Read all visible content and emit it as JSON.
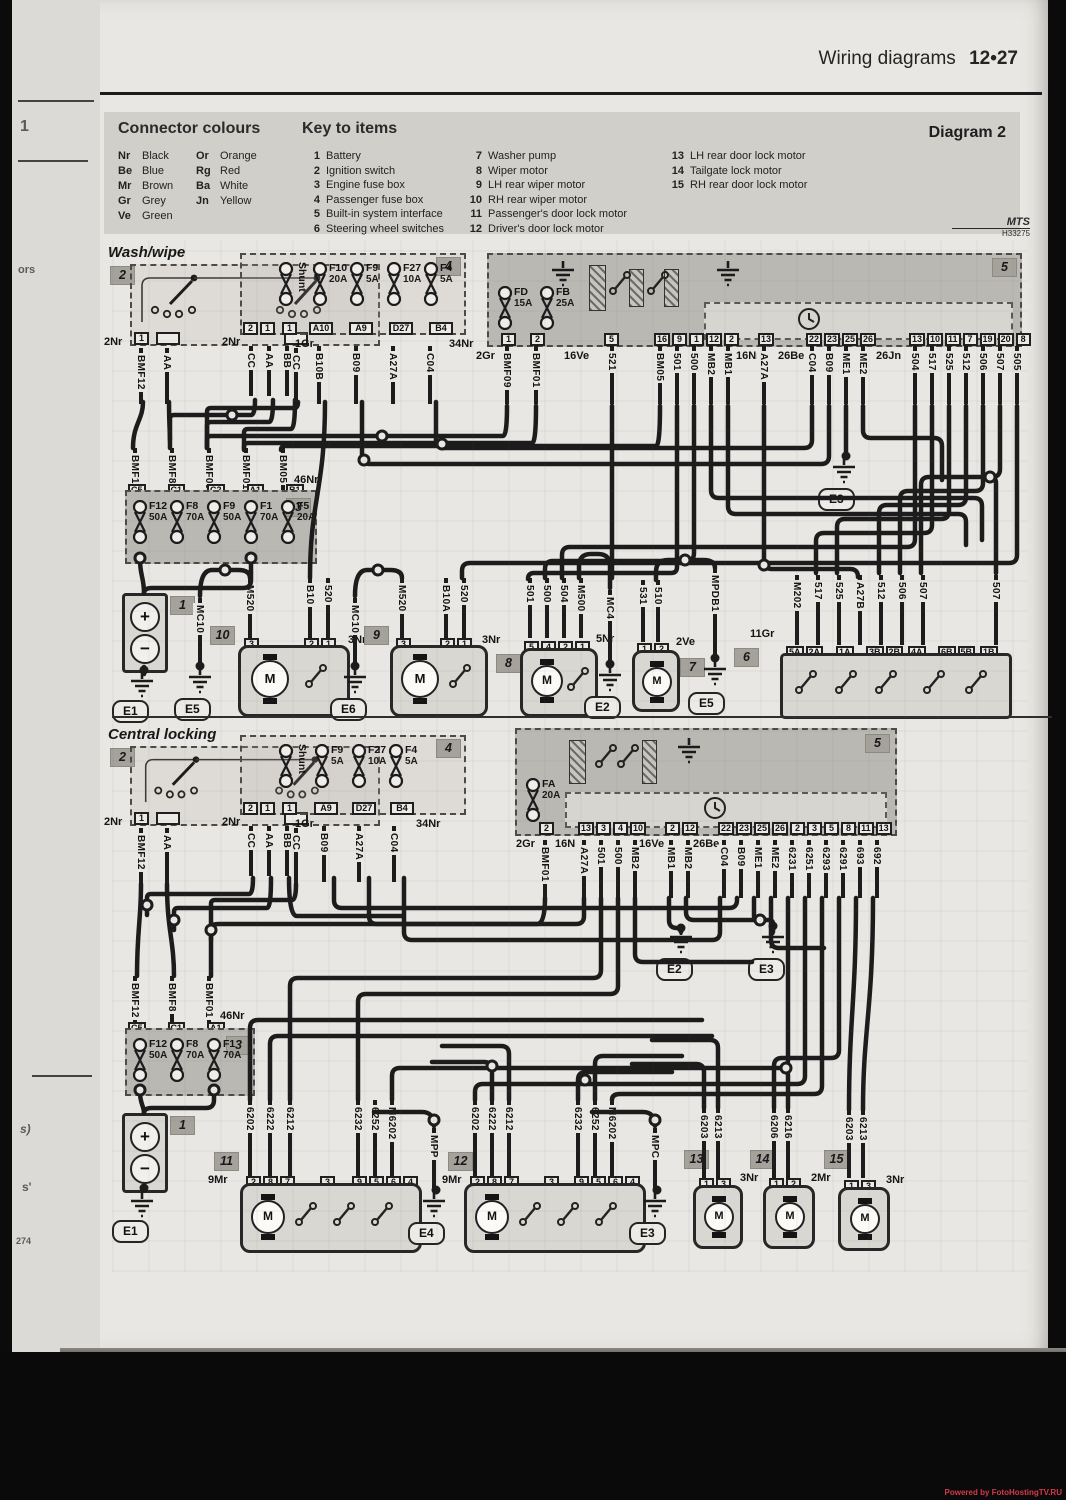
{
  "page": {
    "header_title": "Wiring diagrams",
    "header_page": "12•27",
    "diagram_label": "Diagram 2",
    "sig_brand": "MTS",
    "sig_code": "H33275",
    "watermark": "Powered by FotoHostingTV.RU",
    "margin": {
      "f1": "1",
      "f2": "ors",
      "f3": "s)",
      "f4": "s'",
      "f5": "274"
    }
  },
  "legend": {
    "colours_title": "Connector colours",
    "colours_col1": [
      {
        "code": "Nr",
        "name": "Black"
      },
      {
        "code": "Be",
        "name": "Blue"
      },
      {
        "code": "Mr",
        "name": "Brown"
      },
      {
        "code": "Gr",
        "name": "Grey"
      },
      {
        "code": "Ve",
        "name": "Green"
      }
    ],
    "colours_col2": [
      {
        "code": "Or",
        "name": "Orange"
      },
      {
        "code": "Rg",
        "name": "Red"
      },
      {
        "code": "Ba",
        "name": "White"
      },
      {
        "code": "Jn",
        "name": "Yellow"
      }
    ],
    "key_title": "Key to items",
    "key_col1": [
      {
        "num": "1",
        "label": "Battery"
      },
      {
        "num": "2",
        "label": "Ignition switch"
      },
      {
        "num": "3",
        "label": "Engine fuse box"
      },
      {
        "num": "4",
        "label": "Passenger fuse box"
      },
      {
        "num": "5",
        "label": "Built-in system interface"
      },
      {
        "num": "6",
        "label": "Steering wheel switches"
      }
    ],
    "key_col2": [
      {
        "num": "7",
        "label": "Washer pump"
      },
      {
        "num": "8",
        "label": "Wiper motor"
      },
      {
        "num": "9",
        "label": "LH rear wiper motor"
      },
      {
        "num": "10",
        "label": "RH rear wiper motor"
      },
      {
        "num": "11",
        "label": "Passenger's door lock motor"
      },
      {
        "num": "12",
        "label": "Driver's door lock motor"
      }
    ],
    "key_col3": [
      {
        "num": "13",
        "label": "LH rear door lock motor"
      },
      {
        "num": "14",
        "label": "Tailgate lock motor"
      },
      {
        "num": "15",
        "label": "RH rear door lock motor"
      }
    ]
  },
  "washwipe": {
    "title": "Wash/wipe",
    "ign": {
      "badge": "2",
      "conn": "2Nr",
      "pins": [
        "1",
        "",
        ""
      ],
      "wires": [
        "BMF12",
        "AA",
        "CC"
      ]
    },
    "fusebox4": {
      "badge": "4",
      "shunt": "Shunt",
      "fuses": [
        {
          "name": "F10",
          "amp": "20A"
        },
        {
          "name": "F9",
          "amp": "5A"
        },
        {
          "name": "F27",
          "amp": "10A"
        },
        {
          "name": "F4",
          "amp": "5A"
        }
      ],
      "pins": [
        "2",
        "1",
        "1",
        "A10",
        "A9",
        "D27",
        "B4"
      ],
      "lbl_left": "2Nr",
      "lbl_mid": "1Gr",
      "lbl_right": "34Nr",
      "wires_a": [
        "CC",
        "AA",
        "BB"
      ],
      "wires_b": [
        "B10B",
        "B09",
        "A27A",
        "C04"
      ]
    },
    "sysbox5": {
      "badge": "5",
      "fuses": [
        {
          "name": "FD",
          "amp": "15A"
        },
        {
          "name": "FB",
          "amp": "25A"
        }
      ],
      "g1": {
        "label": "2Gr",
        "pins": [
          "1",
          "2"
        ],
        "wires": [
          "BMF09",
          "BMF01"
        ]
      },
      "g2": {
        "label": "16Ve",
        "pins": [
          "5"
        ],
        "wires": [
          "521"
        ]
      },
      "g3": {
        "pins": [
          "16",
          "9",
          "1",
          "12",
          "2"
        ],
        "wires": [
          "BM05",
          "501",
          "500",
          "MB2",
          "MB1"
        ]
      },
      "g4": {
        "label": "16Nr",
        "pins": [
          "13"
        ],
        "wires": [
          "A27A"
        ]
      },
      "g5": {
        "label": "26Be",
        "pins": [
          "22",
          "23",
          "25",
          "26"
        ],
        "wires": [
          "C04",
          "B09",
          "ME1",
          "ME2"
        ]
      },
      "g6": {
        "label": "26Jn",
        "pins": [
          "13",
          "10",
          "11",
          "7",
          "19",
          "20",
          "8"
        ],
        "wires": [
          "504",
          "517",
          "525",
          "512",
          "506",
          "507",
          "505"
        ]
      }
    },
    "fusebox3": {
      "badge": "3",
      "top": "46Nr",
      "pins": [
        "C5",
        "C1",
        "C2",
        "A1",
        "B1"
      ],
      "fuses": [
        {
          "name": "F12",
          "amp": "50A"
        },
        {
          "name": "F8",
          "amp": "70A"
        },
        {
          "name": "F9",
          "amp": "50A"
        },
        {
          "name": "F1",
          "amp": "70A"
        },
        {
          "name": "F5",
          "amp": "20A"
        }
      ],
      "in_wires": [
        "BMF12",
        "BMF8",
        "BMF09",
        "BMF01",
        "BM05"
      ]
    },
    "battery": {
      "badge": "1",
      "gnd": "E1"
    },
    "gnd_e5a": {
      "wire": "MC10",
      "lbl": "E5"
    },
    "comp10": {
      "badge": "10",
      "conn": "3Nr",
      "pins": [
        "3",
        "2",
        "1"
      ],
      "wires": [
        "M520",
        "B10",
        "520"
      ]
    },
    "gnd_e6": {
      "wire": "MC10",
      "lbl": "E6"
    },
    "comp9": {
      "badge": "9",
      "conn": "3Nr",
      "pins": [
        "3",
        "2",
        "1"
      ],
      "wires": [
        "M520",
        "B10A",
        "520"
      ]
    },
    "comp8": {
      "badge": "8",
      "conn": "5Nr",
      "pins": [
        "5",
        "4",
        "2",
        "1"
      ],
      "wires": [
        "501",
        "500",
        "504",
        "M500"
      ]
    },
    "gnd_e2": {
      "wire": "MC4",
      "lbl": "E2"
    },
    "comp7": {
      "badge": "7",
      "conn": "2Ve",
      "pins": [
        "1",
        "2"
      ],
      "wires": [
        "531",
        "510"
      ]
    },
    "gnd_e5b": {
      "wire": "MPDB1",
      "lbl": "E5"
    },
    "swbox6": {
      "badge": "6",
      "conn": "11Gr",
      "pins": [
        "5A",
        "2A",
        "1A",
        "3B",
        "2B",
        "4A",
        "6B",
        "5B",
        "1B"
      ],
      "wires": [
        "M202",
        "517",
        "525",
        "A27B",
        "512",
        "506",
        "507"
      ],
      "wire_right": "507"
    },
    "gnd_e3": {
      "lbl": "E3"
    }
  },
  "central": {
    "title": "Central locking",
    "ign": {
      "badge": "2",
      "conn": "2Nr",
      "pins": [
        "1",
        "",
        ""
      ],
      "wires": [
        "BMF12",
        "AA",
        "CC"
      ]
    },
    "fusebox4": {
      "badge": "4",
      "shunt": "Shunt",
      "fuses": [
        {
          "name": "F9",
          "amp": "5A"
        },
        {
          "name": "F27",
          "amp": "10A"
        },
        {
          "name": "F4",
          "amp": "5A"
        }
      ],
      "pins": [
        "2",
        "1",
        "1",
        "A9",
        "D27",
        "B4"
      ],
      "lbl_left": "2Nr",
      "lbl_mid": "1Gr",
      "lbl_right": "34Nr",
      "wires_a": [
        "CC",
        "AA",
        "BB"
      ],
      "wires_b": [
        "B09",
        "A27A",
        "C04"
      ]
    },
    "sysbox5": {
      "badge": "5",
      "fuses": [
        {
          "name": "FA",
          "amp": "20A"
        }
      ],
      "g1": {
        "label": "2Gr",
        "pins": [
          "2"
        ],
        "wires": [
          "BMF01"
        ]
      },
      "g2": {
        "label": "16N",
        "pins": [
          "13",
          "3",
          "4",
          "10"
        ],
        "wires": [
          "A27A",
          "501",
          "500",
          "MB2"
        ]
      },
      "g3": {
        "label": "16Ve",
        "pins": [
          "2",
          "12"
        ],
        "wires": [
          "MB1",
          "MB2"
        ]
      },
      "g4": {
        "label": "26Be",
        "pins": [
          "22",
          "23",
          "25",
          "26",
          "2",
          "3",
          "5",
          "8",
          "11",
          "13"
        ],
        "wires": [
          "C04",
          "B09",
          "ME1",
          "ME2",
          "6231",
          "6251",
          "6293",
          "6291",
          "693",
          "692"
        ]
      }
    },
    "gnd_e2": {
      "lbl": "E2"
    },
    "gnd_e3": {
      "lbl": "E3"
    },
    "fusebox3": {
      "badge": "3",
      "top": "46Nr",
      "pins": [
        "C5",
        "C1",
        "A1"
      ],
      "fuses": [
        {
          "name": "F12",
          "amp": "50A"
        },
        {
          "name": "F8",
          "amp": "70A"
        },
        {
          "name": "F1",
          "amp": "70A"
        }
      ],
      "in_wires": [
        "BMF12",
        "BMF8",
        "BMF01"
      ]
    },
    "battery": {
      "badge": "1",
      "gnd": "E1"
    },
    "comp11": {
      "badge": "11",
      "conn": "9Mr",
      "pins": [
        "2",
        "8",
        "7",
        "3",
        "9",
        "5",
        "6",
        "4"
      ],
      "wires_a": [
        "6202",
        "6222",
        "6212"
      ],
      "wires_b": [
        "6232",
        "6252",
        "M6202"
      ]
    },
    "gnd_e4": {
      "wire": "MPP",
      "lbl": "E4"
    },
    "comp12": {
      "badge": "12",
      "conn": "9Mr",
      "pins": [
        "2",
        "8",
        "7",
        "3",
        "9",
        "5",
        "6",
        "4"
      ],
      "wires_a": [
        "6202",
        "6222",
        "6212"
      ],
      "wires_b": [
        "6232",
        "6252",
        "M6202"
      ]
    },
    "gnd_e3b": {
      "wire": "MPC",
      "lbl": "E3"
    },
    "comp13": {
      "badge": "13",
      "conn": "3Nr",
      "pins": [
        "1",
        "3"
      ],
      "wires": [
        "6203",
        "6213"
      ]
    },
    "comp14": {
      "badge": "14",
      "conn": "2Mr",
      "pins": [
        "1",
        "2"
      ],
      "wires": [
        "6206",
        "6216"
      ]
    },
    "comp15": {
      "badge": "15",
      "conn": "3Nr",
      "pins": [
        "1",
        "3"
      ],
      "wires": [
        "6203",
        "6213"
      ]
    }
  },
  "symbols": {
    "motor": "M",
    "plus": "+",
    "minus": "−"
  }
}
